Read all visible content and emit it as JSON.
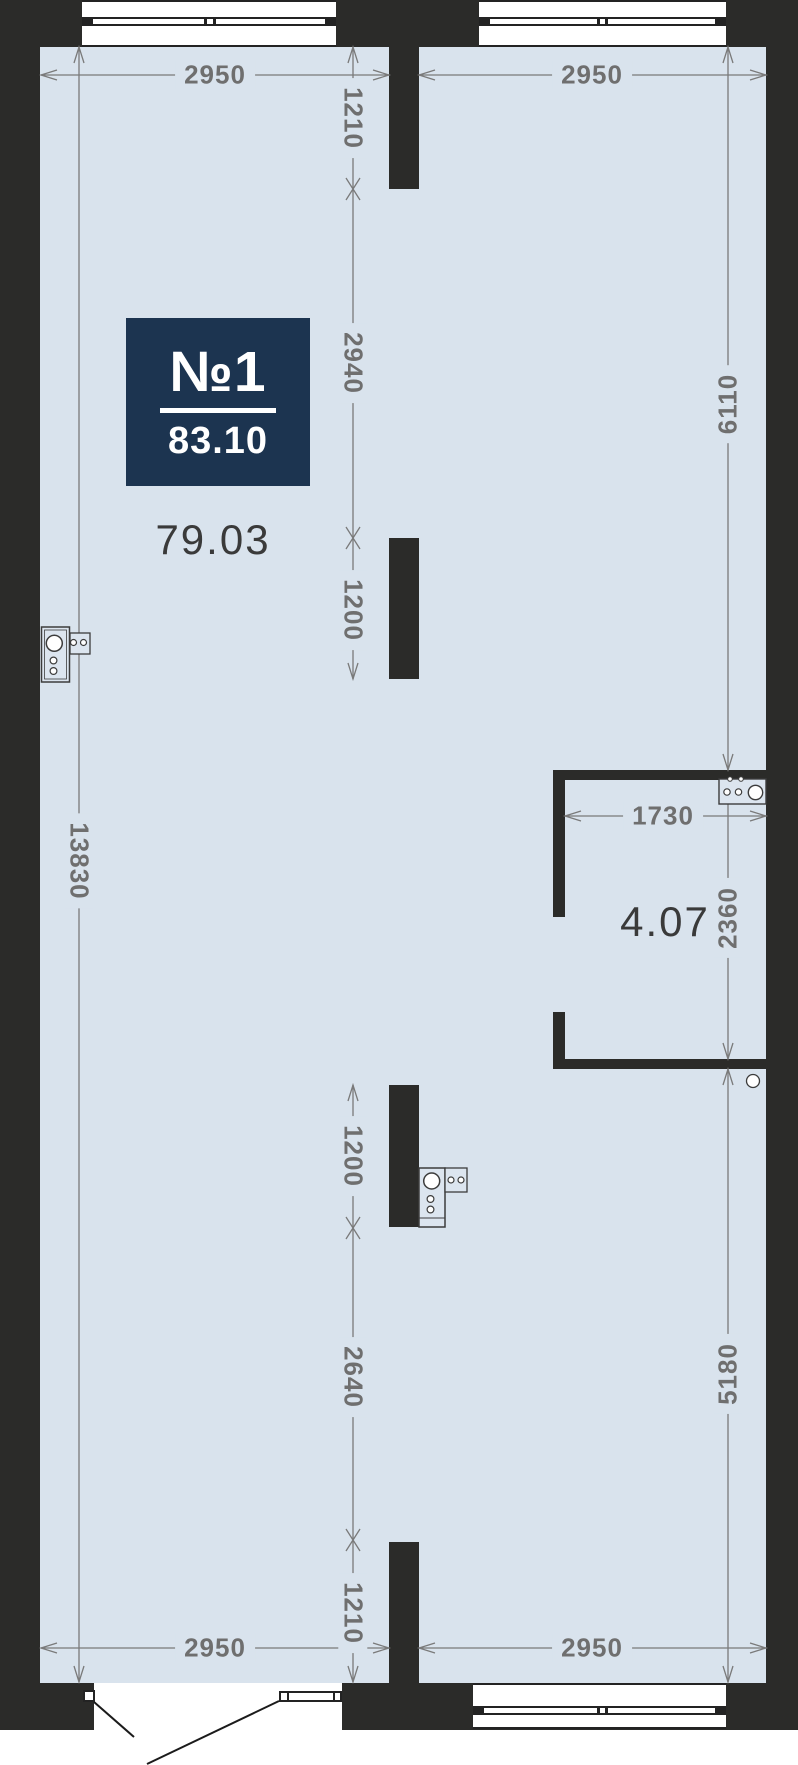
{
  "badge": {
    "unit_number": "№1",
    "total_area": "83.10"
  },
  "areas": {
    "main_room": "79.03",
    "bathroom": "4.07"
  },
  "dimensions": {
    "top_left": "2950",
    "top_right": "2950",
    "bottom_left": "2950",
    "bottom_right": "2950",
    "left_total": "13830",
    "col_mid": {
      "d1": "1210",
      "d2": "2940",
      "d3": "1200",
      "d4": "1200",
      "d5": "2640",
      "d6": "1210"
    },
    "col_right": {
      "d1": "6110",
      "d2": "2360",
      "d3": "5180"
    },
    "bath_width": "1730"
  },
  "colors": {
    "wall": "#2b2b29",
    "floor": "#d9e3ed",
    "badge_bg": "#1c3450",
    "dim_text": "#6f6f6f",
    "area_text": "#3a3a3a"
  },
  "icons": [
    "stove-icon",
    "sink-icon",
    "sprinkler-icon",
    "window",
    "door-swing"
  ]
}
